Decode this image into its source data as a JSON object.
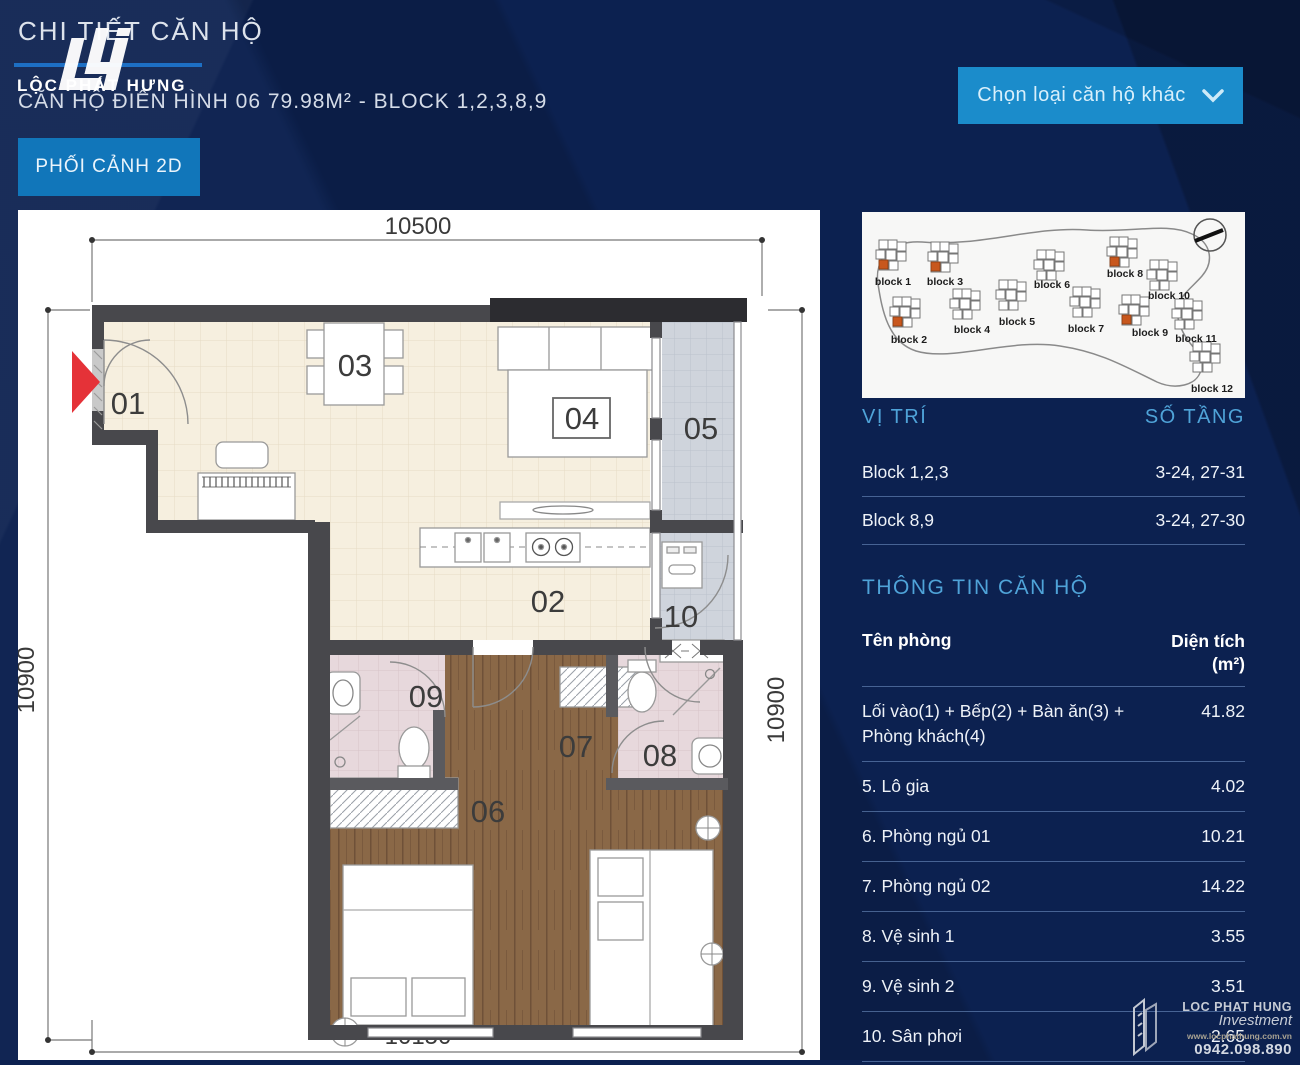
{
  "page": {
    "title": "CHI TIẾT CĂN HỘ",
    "subtitle": "CĂN HỘ ĐIỂN HÌNH 06 79.98M² - BLOCK 1,2,3,8,9"
  },
  "brand": {
    "logo_text": "LỘC PHÁT HƯNG",
    "footer_name": "LOC PHAT HUNG",
    "footer_sub": "Investment",
    "website": "www.locphathung.com.vn",
    "phone": "0942.098.890"
  },
  "buttons": {
    "view_2d": "PHỐI CẢNH 2D",
    "choose_unit": "Chọn loại căn hộ khác"
  },
  "floorplan": {
    "dim_top": "10500",
    "dim_left": "10900",
    "dim_right": "10900",
    "dim_bottom": "10150",
    "rooms": [
      {
        "label": "01"
      },
      {
        "label": "02"
      },
      {
        "label": "03"
      },
      {
        "label": "04"
      },
      {
        "label": "05"
      },
      {
        "label": "06"
      },
      {
        "label": "07"
      },
      {
        "label": "08"
      },
      {
        "label": "09"
      },
      {
        "label": "10"
      }
    ]
  },
  "blockmap": {
    "blocks": [
      {
        "label": "block 1"
      },
      {
        "label": "block 2"
      },
      {
        "label": "block 3"
      },
      {
        "label": "block 4"
      },
      {
        "label": "block 5"
      },
      {
        "label": "block 6"
      },
      {
        "label": "block 7"
      },
      {
        "label": "block 8"
      },
      {
        "label": "block 9"
      },
      {
        "label": "block 10"
      },
      {
        "label": "block 11"
      },
      {
        "label": "block 12"
      }
    ],
    "highlighted_blocks": "1,2,3,8,9",
    "highlight_color": "#c8571d"
  },
  "location_table": {
    "col_location": "VỊ TRÍ",
    "col_floors": "SỐ TẦNG",
    "rows": [
      {
        "location": "Block 1,2,3",
        "floors": "3-24, 27-31"
      },
      {
        "location": "Block 8,9",
        "floors": "3-24, 27-30"
      }
    ]
  },
  "info_table": {
    "title": "THÔNG TIN CĂN HỘ",
    "col_room": "Tên phòng",
    "col_area": "Diện tích",
    "col_area_unit": "(m²)",
    "rows": [
      {
        "room": "Lối vào(1) + Bếp(2) + Bàn ăn(3) + Phòng khách(4)",
        "area": "41.82"
      },
      {
        "room": "5. Lô gia",
        "area": "4.02"
      },
      {
        "room": "6. Phòng ngủ 01",
        "area": "10.21"
      },
      {
        "room": "7. Phòng ngủ 02",
        "area": "14.22"
      },
      {
        "room": "8. Vệ sinh 1",
        "area": "3.55"
      },
      {
        "room": "9. Vệ sinh 2",
        "area": "3.51"
      },
      {
        "room": "10. Sân phơi",
        "area": "2.65"
      }
    ]
  },
  "colors": {
    "background": "#0c2150",
    "accent": "#4fa3d8",
    "button_blue": "#1176ba",
    "dropdown_blue": "#1b8ccb",
    "entry_arrow_red": "#e53238"
  }
}
